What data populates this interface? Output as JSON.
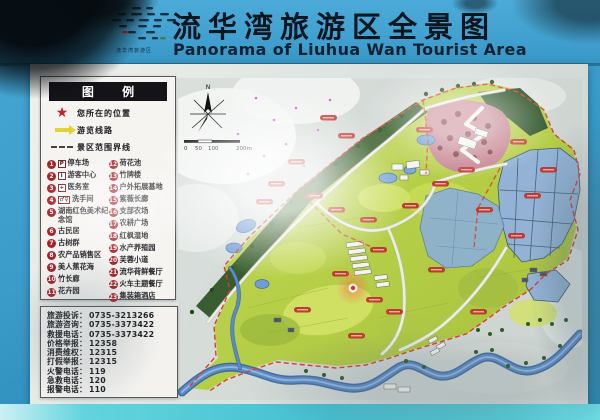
{
  "header": {
    "title_zh": "流华湾旅游区全景图",
    "title_en": "Panorama of Liuhua Wan Tourist Area",
    "logo_caption": "流华湾旅游区"
  },
  "legend": {
    "title": "图 例",
    "symbol_items": [
      {
        "symbol": "red-star",
        "label": "您所在的位置"
      },
      {
        "symbol": "yellow-arrow",
        "label": "游览线路"
      },
      {
        "symbol": "dashed-line",
        "label": "景区范围界线"
      }
    ],
    "numbered_items_left": [
      {
        "num": "1",
        "badge": "P",
        "label": "停车场"
      },
      {
        "num": "2",
        "badge": "i",
        "label": "游客中心"
      },
      {
        "num": "3",
        "badge": "+",
        "label": "医务室"
      },
      {
        "num": "4",
        "badge": "♂♀",
        "label": "洗手间"
      },
      {
        "num": "5",
        "label": "湖南红色美术纪念馆"
      },
      {
        "num": "6",
        "label": "古民居"
      },
      {
        "num": "7",
        "label": "古树群"
      },
      {
        "num": "8",
        "label": "农产品销售区"
      },
      {
        "num": "9",
        "label": "美人蕉花海"
      },
      {
        "num": "10",
        "label": "竹长廊"
      },
      {
        "num": "11",
        "label": "花卉园"
      }
    ],
    "numbered_items_right": [
      {
        "num": "12",
        "label": "荷花池"
      },
      {
        "num": "13",
        "label": "竹牌楼"
      },
      {
        "num": "14",
        "label": "户外拓展基地"
      },
      {
        "num": "15",
        "label": "紫薇长廊"
      },
      {
        "num": "16",
        "label": "支部农场"
      },
      {
        "num": "17",
        "label": "农耕广场"
      },
      {
        "num": "18",
        "label": "红枫湿地"
      },
      {
        "num": "19",
        "label": "水产养殖园"
      },
      {
        "num": "20",
        "label": "芙蓉小道"
      },
      {
        "num": "21",
        "label": "流华荷鲜餐厅"
      },
      {
        "num": "22",
        "label": "火车主题餐厅"
      },
      {
        "num": "23",
        "label": "集装箱酒店"
      }
    ]
  },
  "contacts": [
    {
      "label": "旅游投诉：",
      "number": "0735-3213266"
    },
    {
      "label": "旅游咨询：",
      "number": "0735-3373422"
    },
    {
      "label": "救援电话：",
      "number": "0735-3373422"
    },
    {
      "label": "价格举报：",
      "number": "12358"
    },
    {
      "label": "消费维权：",
      "number": "12315"
    },
    {
      "label": "打假举报：",
      "number": "12315"
    },
    {
      "label": "火警电话：",
      "number": "119"
    },
    {
      "label": "急救电话：",
      "number": "120"
    },
    {
      "label": "报警电话：",
      "number": "110"
    }
  ],
  "map": {
    "compass_label": "N",
    "scale_ticks": {
      "t0": "0",
      "t50": "50",
      "t100": "100",
      "t200": "200m"
    }
  },
  "colors": {
    "header_blue": "#3f9ecd",
    "frame_cyan": "#45bfd0",
    "board_white": "#e4e9e6",
    "legend_red": "#ab2128",
    "boundary_red": "#e03a2a",
    "land_green": "#b9d14c",
    "water_blue": "#5c8cc8",
    "paddy_blue": "#93b3d6",
    "maple_pink": "#c4818d"
  }
}
